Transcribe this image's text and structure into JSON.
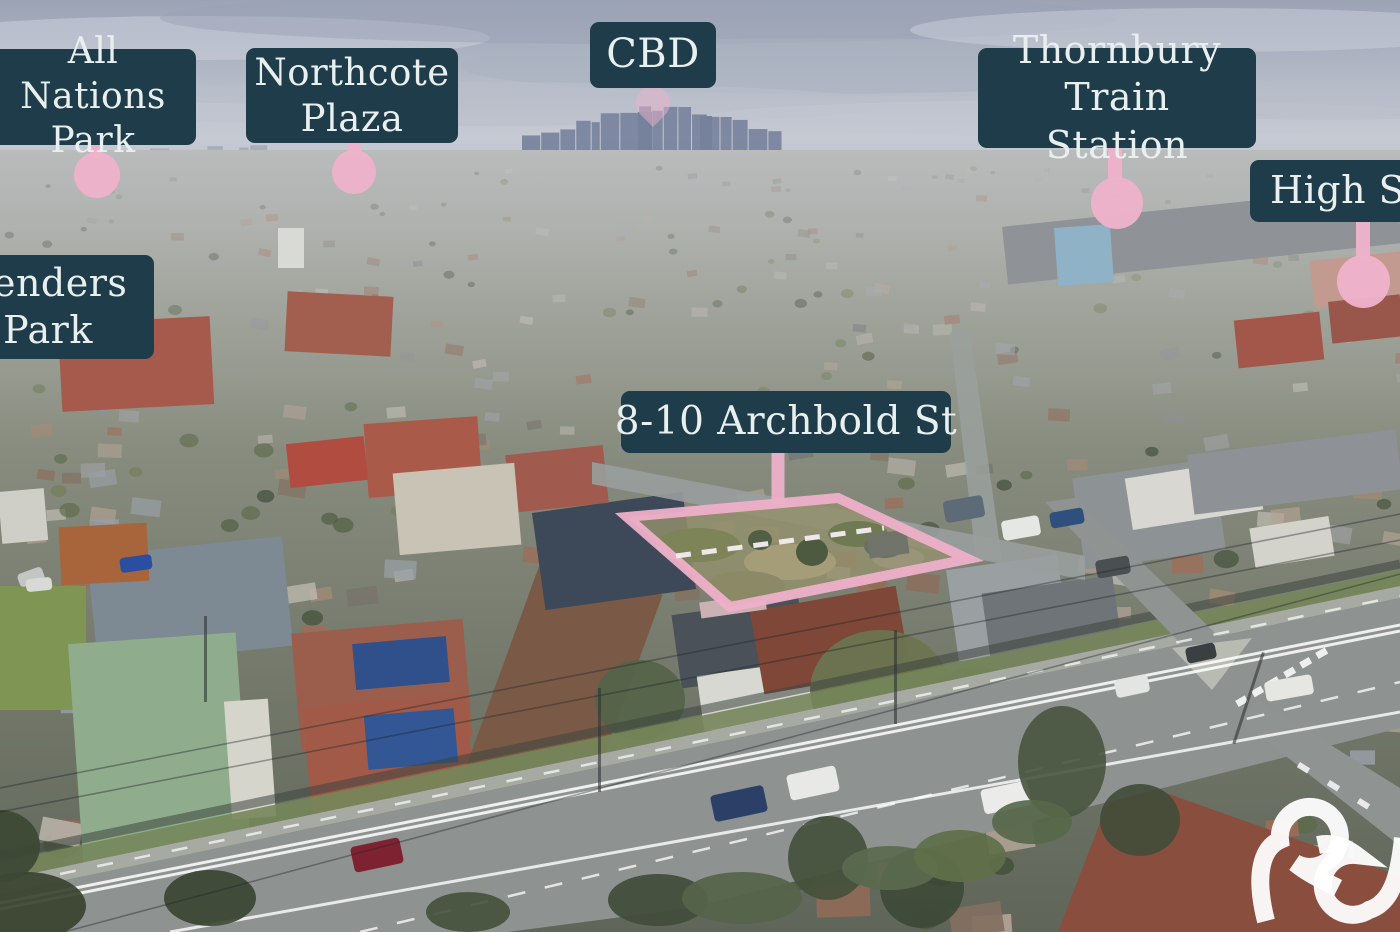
{
  "callouts": [
    {
      "id": "all-nations-park",
      "label": "All Nations Park",
      "marker": "pin-circle"
    },
    {
      "id": "northcote-plaza",
      "label": "Northcote Plaza",
      "marker": "pin-circle"
    },
    {
      "id": "cbd",
      "label": "CBD",
      "marker": "pin-teardrop"
    },
    {
      "id": "thornbury-train-station",
      "label": "Thornbury Train Station",
      "marker": "pin-circle"
    },
    {
      "id": "high-street",
      "label": "High Street",
      "marker": "pin-circle"
    },
    {
      "id": "penders-park",
      "label": "Penders Park",
      "marker": "none"
    },
    {
      "id": "property",
      "label": "8-10 Archbold St",
      "marker": "boundary-stem"
    }
  ],
  "property_boundary": {
    "style": "pink-outline-with-dashed-divider"
  },
  "watermark": {
    "icon": "ampersand-logo"
  },
  "colors": {
    "label_bg": "#1f3c4a",
    "label_text": "#e9efee",
    "marker_pink": "#eeb2cb",
    "boundary_pink": "#eeb0c9",
    "watermark_white": "#ffffff"
  }
}
